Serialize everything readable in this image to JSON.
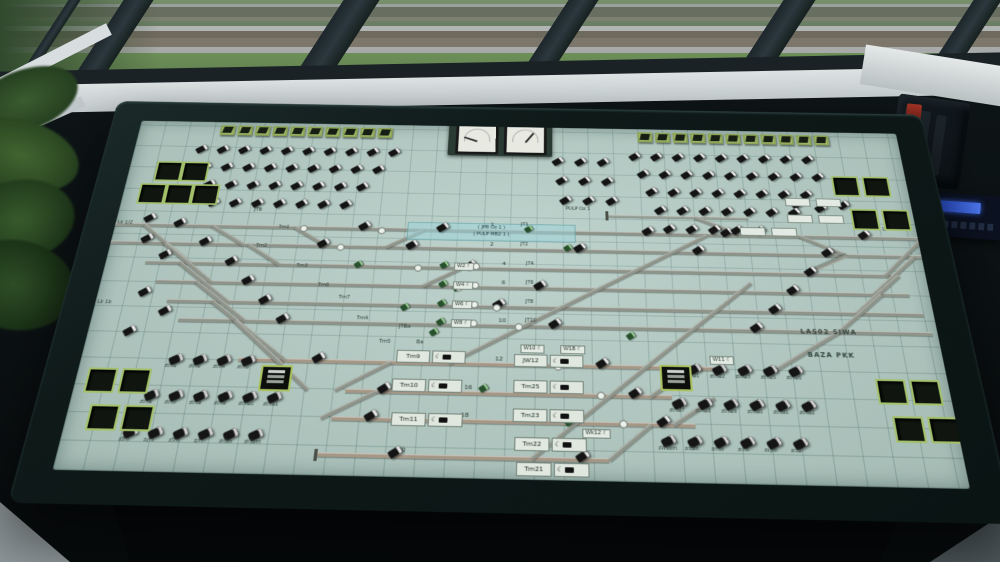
{
  "colors": {
    "panel_green": "#b7cec7",
    "key_green": "#a8bf70",
    "track_gray": "#8f948a",
    "track_tan": "#a49786",
    "strip_blue": "#9ed4da",
    "radio_screen_blue": "#3a62e0"
  },
  "gauges": {
    "left_needle_deg": 200,
    "right_needle_deg": -55
  },
  "panel": {
    "station_labels": [
      [
        385,
        120,
        "1",
        "s6"
      ],
      [
        385,
        143,
        "2",
        "s6"
      ],
      [
        398,
        165,
        "4",
        "s6"
      ],
      [
        398,
        186,
        "6",
        "s6"
      ],
      [
        398,
        207,
        "8",
        "s6"
      ],
      [
        396,
        227,
        "10",
        "s6"
      ],
      [
        394,
        267,
        "12",
        "s6"
      ],
      [
        366,
        296,
        "16",
        "s6"
      ],
      [
        364,
        323,
        "18",
        "s6"
      ],
      [
        308,
        357,
        "20",
        "s6"
      ],
      [
        416,
        120,
        "JT1",
        ""
      ],
      [
        416,
        143,
        "JT2",
        ""
      ],
      [
        422,
        165,
        "JT4",
        ""
      ],
      [
        422,
        186,
        "JT6",
        ""
      ],
      [
        422,
        207,
        "JT8",
        ""
      ],
      [
        422,
        227,
        "JT10",
        ""
      ],
      [
        462,
        100,
        "PULP Oz 1",
        ""
      ],
      [
        688,
        232,
        "LAS02 SIWA",
        "big"
      ],
      [
        692,
        256,
        "BAZA PKK",
        "big"
      ],
      [
        2,
        126,
        "Lk 1/2",
        ""
      ],
      [
        2,
        216,
        "Lk 1b",
        ""
      ],
      [
        778,
        118,
        "Lk 1/2",
        ""
      ],
      [
        140,
        108,
        "JTB",
        ""
      ],
      [
        168,
        128,
        "Tm1",
        ""
      ],
      [
        148,
        150,
        "Tm2",
        ""
      ],
      [
        192,
        172,
        "Tm3",
        ""
      ],
      [
        216,
        193,
        "Tm6",
        ""
      ],
      [
        238,
        206,
        "Tm7",
        ""
      ],
      [
        258,
        228,
        "Tm4",
        ""
      ],
      [
        282,
        252,
        "Tm5",
        ""
      ],
      [
        300,
        236,
        "JTBa",
        ""
      ],
      [
        318,
        252,
        "Ba",
        ""
      ]
    ],
    "tracks": [
      {
        "y": 130,
        "x1": 0,
        "x2": 820,
        "tone": "gray"
      },
      {
        "y": 151,
        "x1": 0,
        "x2": 820,
        "tone": "gray"
      },
      {
        "y": 173,
        "x1": 40,
        "x2": 790,
        "tone": "gray"
      },
      {
        "y": 194,
        "x1": 55,
        "x2": 800,
        "tone": "gray"
      },
      {
        "y": 215,
        "x1": 70,
        "x2": 810,
        "tone": "gray"
      },
      {
        "y": 235,
        "x1": 85,
        "x2": 815,
        "tone": "gray"
      },
      {
        "y": 275,
        "x1": 150,
        "x2": 605,
        "tone": "tan"
      },
      {
        "y": 304,
        "x1": 255,
        "x2": 560,
        "tone": "tan"
      },
      {
        "y": 331,
        "x1": 245,
        "x2": 580,
        "tone": "tan"
      },
      {
        "y": 365,
        "x1": 236,
        "x2": 500,
        "tone": "tan"
      },
      {
        "y": 110,
        "x1": 505,
        "x2": 650,
        "tone": "thin"
      }
    ],
    "diagonals": [
      [
        30,
        130,
        85,
        173
      ],
      [
        55,
        151,
        110,
        194
      ],
      [
        75,
        173,
        130,
        215
      ],
      [
        95,
        194,
        150,
        235
      ],
      [
        115,
        215,
        195,
        275
      ],
      [
        140,
        235,
        220,
        304
      ],
      [
        245,
        304,
        295,
        275
      ],
      [
        235,
        331,
        285,
        304
      ],
      [
        100,
        130,
        135,
        151
      ],
      [
        140,
        151,
        175,
        173
      ],
      [
        185,
        130,
        220,
        151
      ],
      [
        280,
        151,
        318,
        130
      ],
      [
        320,
        194,
        358,
        173
      ],
      [
        350,
        275,
        605,
        131
      ],
      [
        430,
        365,
        645,
        184
      ],
      [
        540,
        304,
        580,
        275
      ],
      [
        560,
        331,
        600,
        304
      ],
      [
        500,
        365,
        540,
        331
      ],
      [
        780,
        173,
        823,
        131
      ],
      [
        765,
        194,
        813,
        151
      ],
      [
        745,
        215,
        793,
        173
      ],
      [
        725,
        235,
        773,
        194
      ],
      [
        660,
        275,
        725,
        235
      ],
      [
        700,
        130,
        745,
        151
      ],
      [
        745,
        151,
        700,
        173
      ],
      [
        595,
        110,
        638,
        128
      ]
    ],
    "signals": [
      [
        60,
        123
      ],
      [
        250,
        123
      ],
      [
        330,
        123
      ],
      [
        540,
        123
      ],
      [
        620,
        123
      ],
      [
        760,
        123
      ],
      [
        90,
        144
      ],
      [
        210,
        144
      ],
      [
        300,
        144
      ],
      [
        470,
        144
      ],
      [
        590,
        144
      ],
      [
        720,
        144
      ],
      [
        120,
        166
      ],
      [
        360,
        166
      ],
      [
        700,
        166
      ],
      [
        140,
        187
      ],
      [
        430,
        187
      ],
      [
        680,
        187
      ],
      [
        160,
        208
      ],
      [
        390,
        208
      ],
      [
        660,
        208
      ],
      [
        180,
        228
      ],
      [
        445,
        228
      ],
      [
        640,
        228
      ],
      [
        220,
        268
      ],
      [
        490,
        268
      ],
      [
        285,
        297
      ],
      [
        520,
        297
      ],
      [
        275,
        324
      ],
      [
        545,
        324
      ],
      [
        300,
        358
      ],
      [
        470,
        358
      ],
      [
        30,
        142
      ],
      [
        52,
        160
      ],
      [
        40,
        202
      ],
      [
        64,
        222
      ],
      [
        34,
        244
      ],
      [
        28,
        118
      ],
      [
        696,
        88
      ],
      [
        720,
        92
      ],
      [
        744,
        88
      ]
    ],
    "green_buttons": [
      [
        250,
        168
      ],
      [
        420,
        124
      ],
      [
        460,
        145
      ],
      [
        350,
        192
      ],
      [
        330,
        240
      ],
      [
        430,
        268
      ],
      [
        380,
        296
      ],
      [
        460,
        327
      ],
      [
        300,
        214
      ],
      [
        520,
        240
      ],
      [
        336,
        167
      ],
      [
        336,
        188
      ],
      [
        336,
        209
      ],
      [
        336,
        229
      ]
    ],
    "white_circles": [
      [
        190,
        127
      ],
      [
        230,
        148
      ],
      [
        310,
        170
      ],
      [
        352,
        191
      ],
      [
        390,
        212
      ],
      [
        412,
        232
      ],
      [
        450,
        272
      ],
      [
        490,
        300
      ],
      [
        510,
        327
      ],
      [
        270,
        128
      ],
      [
        368,
        167
      ],
      [
        368,
        188
      ],
      [
        368,
        209
      ],
      [
        368,
        229
      ]
    ],
    "key_rows": [
      {
        "x": 88,
        "y": 4,
        "n": 10,
        "step": 19
      },
      {
        "x": 540,
        "y": 4,
        "n": 11,
        "step": 19
      }
    ],
    "button_grid": [
      [
        66,
        32,
        10,
        23
      ],
      [
        74,
        54,
        9,
        23
      ],
      [
        82,
        76,
        8,
        23
      ],
      [
        90,
        98,
        7,
        23
      ],
      [
        530,
        32,
        9,
        23
      ],
      [
        538,
        54,
        9,
        23
      ],
      [
        546,
        76,
        8,
        23
      ],
      [
        554,
        98,
        7,
        23
      ],
      [
        562,
        120,
        5,
        23
      ],
      [
        448,
        40,
        3,
        24
      ],
      [
        452,
        64,
        3,
        24
      ],
      [
        456,
        88,
        3,
        24
      ]
    ],
    "labeled_buttons": [
      [
        84,
        272,
        "ztm1"
      ],
      [
        107,
        272,
        "ztm2"
      ],
      [
        130,
        272,
        "ztm4"
      ],
      [
        153,
        272,
        "ztm5"
      ],
      [
        68,
        308,
        "ztm6"
      ],
      [
        91,
        308,
        "ztm7"
      ],
      [
        114,
        308,
        "ztm8"
      ],
      [
        137,
        308,
        "ztm9"
      ],
      [
        160,
        308,
        "ztm10"
      ],
      [
        183,
        308,
        "ztm11"
      ],
      [
        56,
        344,
        "z8m"
      ],
      [
        79,
        344,
        "zym"
      ],
      [
        102,
        344,
        "z5m"
      ],
      [
        125,
        344,
        "zjm"
      ],
      [
        148,
        344,
        "zk8m"
      ],
      [
        171,
        344,
        "zk10m"
      ],
      [
        576,
        272,
        "ztm21"
      ],
      [
        600,
        272,
        "ztm22"
      ],
      [
        624,
        272,
        "ztm23"
      ],
      [
        648,
        272,
        "ztm25"
      ],
      [
        672,
        272,
        "ztm26"
      ],
      [
        560,
        306,
        "ztm27"
      ],
      [
        584,
        306,
        "ztm28"
      ],
      [
        608,
        306,
        "ztm29"
      ],
      [
        632,
        306,
        "ztm30"
      ],
      [
        656,
        306,
        "ztm31"
      ],
      [
        680,
        306,
        "ztm32"
      ],
      [
        548,
        342,
        "zW16m"
      ],
      [
        572,
        342,
        "zdBm"
      ],
      [
        596,
        342,
        "zmm"
      ],
      [
        620,
        342,
        "znm"
      ],
      [
        644,
        342,
        "zsym"
      ],
      [
        668,
        342,
        "zrzb"
      ]
    ],
    "switch_boxes": [
      [
        350,
        167,
        "W2"
      ],
      [
        350,
        188,
        "W4"
      ],
      [
        350,
        209,
        "W6"
      ],
      [
        350,
        229,
        "W8"
      ],
      [
        418,
        254,
        "W10"
      ],
      [
        456,
        254,
        "W1B"
      ],
      [
        598,
        262,
        "W11"
      ],
      [
        476,
        336,
        "Wk12"
      ]
    ],
    "blank_boxes": [
      [
        690,
        84
      ],
      [
        722,
        84
      ],
      [
        690,
        104
      ],
      [
        722,
        104
      ],
      [
        640,
        120
      ],
      [
        672,
        120
      ]
    ],
    "tm_boxes": [
      [
        412,
        264,
        "JW12"
      ],
      [
        412,
        290,
        "Tm25"
      ],
      [
        412,
        318,
        "Tm23"
      ],
      [
        414,
        345,
        "Tm22"
      ],
      [
        416,
        368,
        "Tm21"
      ],
      [
        300,
        262,
        "Tm9"
      ],
      [
        298,
        291,
        "Tm10"
      ],
      [
        300,
        324,
        "Tm11"
      ]
    ],
    "counters": [
      [
        173,
        280
      ],
      [
        550,
        272
      ]
    ],
    "green_squares": [
      [
        28,
        52
      ],
      [
        56,
        52
      ],
      [
        16,
        80
      ],
      [
        44,
        80
      ],
      [
        72,
        80
      ],
      [
        742,
        56
      ],
      [
        774,
        56
      ],
      [
        756,
        96
      ],
      [
        788,
        96
      ],
      [
        10,
        286
      ],
      [
        42,
        286
      ],
      [
        20,
        322
      ],
      [
        52,
        322
      ],
      [
        752,
        282
      ],
      [
        784,
        282
      ],
      [
        762,
        318
      ],
      [
        794,
        318
      ]
    ],
    "bumpers": [
      [
        233,
        360
      ],
      [
        503,
        104
      ]
    ],
    "blue_strip": {
      "x": 300,
      "y": 121,
      "w": 170,
      "h": 19,
      "line1": "( JPB Oz 1 )",
      "line2": "( PULP MB2 1 )"
    }
  }
}
